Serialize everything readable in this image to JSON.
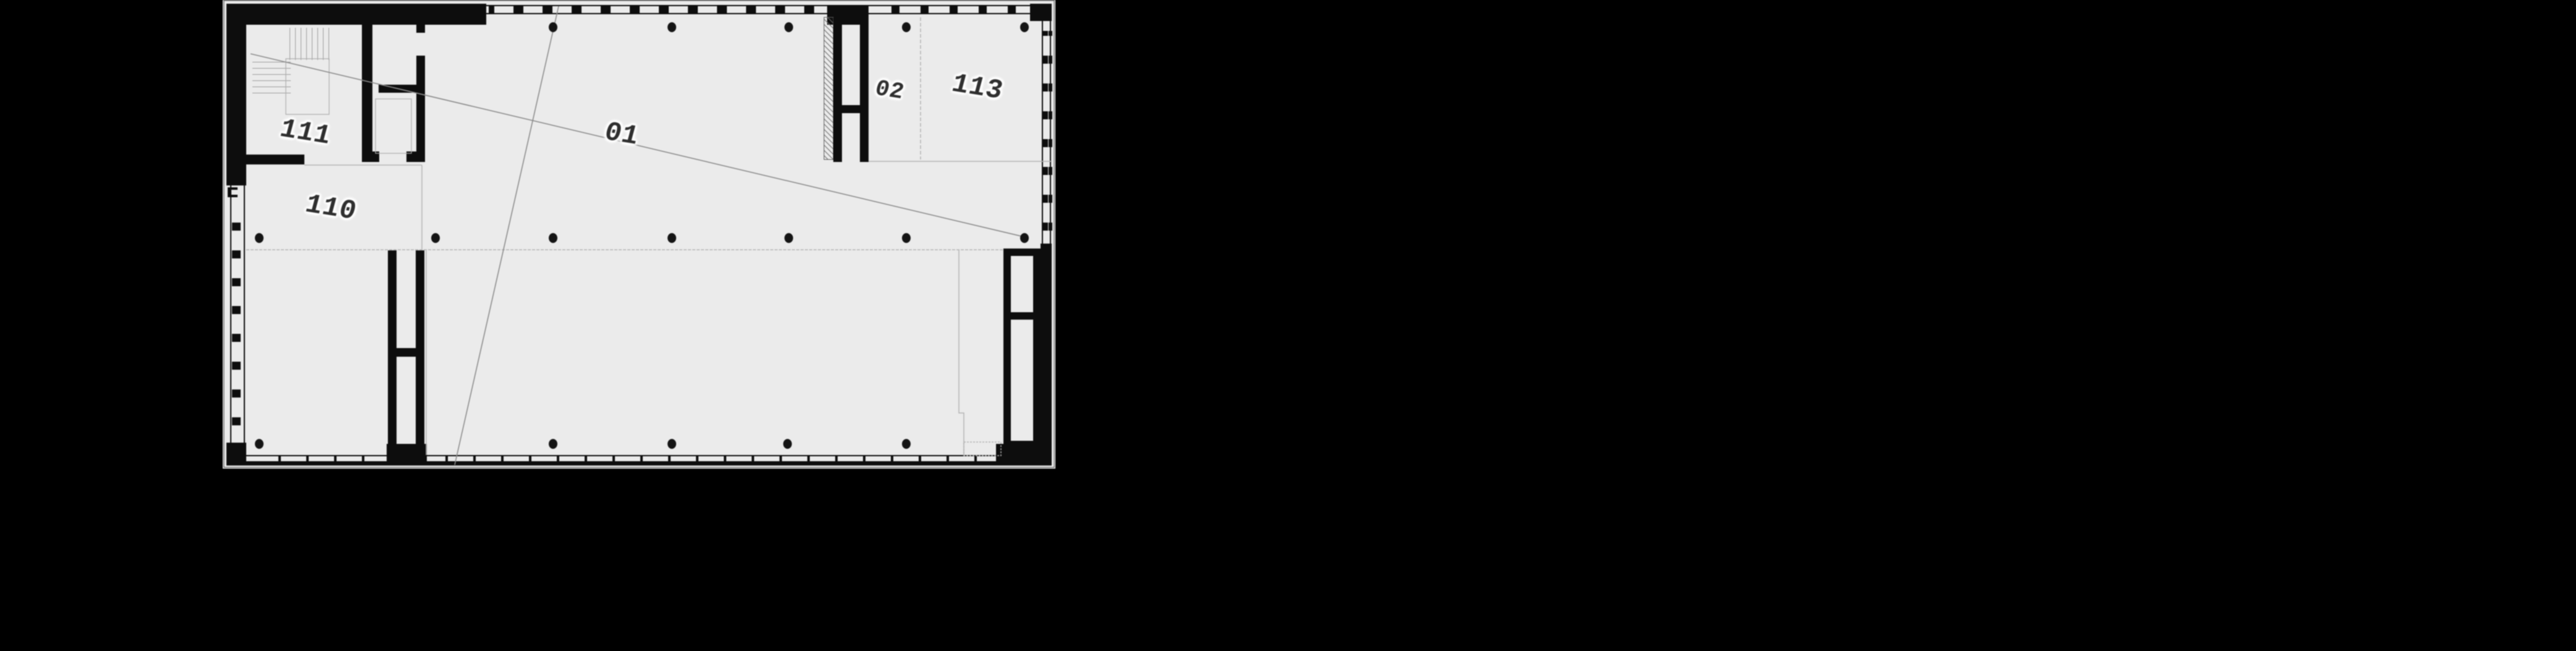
{
  "plan": {
    "labels": [
      {
        "id": "room-111",
        "text": "111"
      },
      {
        "id": "room-110",
        "text": "110"
      },
      {
        "id": "space-01",
        "text": "01"
      },
      {
        "id": "space-02",
        "text": "02"
      },
      {
        "id": "room-113",
        "text": "113"
      }
    ],
    "colors": {
      "page_bg": "#000000",
      "paper": "#ebebeb",
      "wall": "#0d0d0d",
      "line_faint": "#b3b3b3",
      "line_leader": "#8c8c8c",
      "label_ink": "#2e2e2e",
      "halo": "#ffffff"
    }
  }
}
